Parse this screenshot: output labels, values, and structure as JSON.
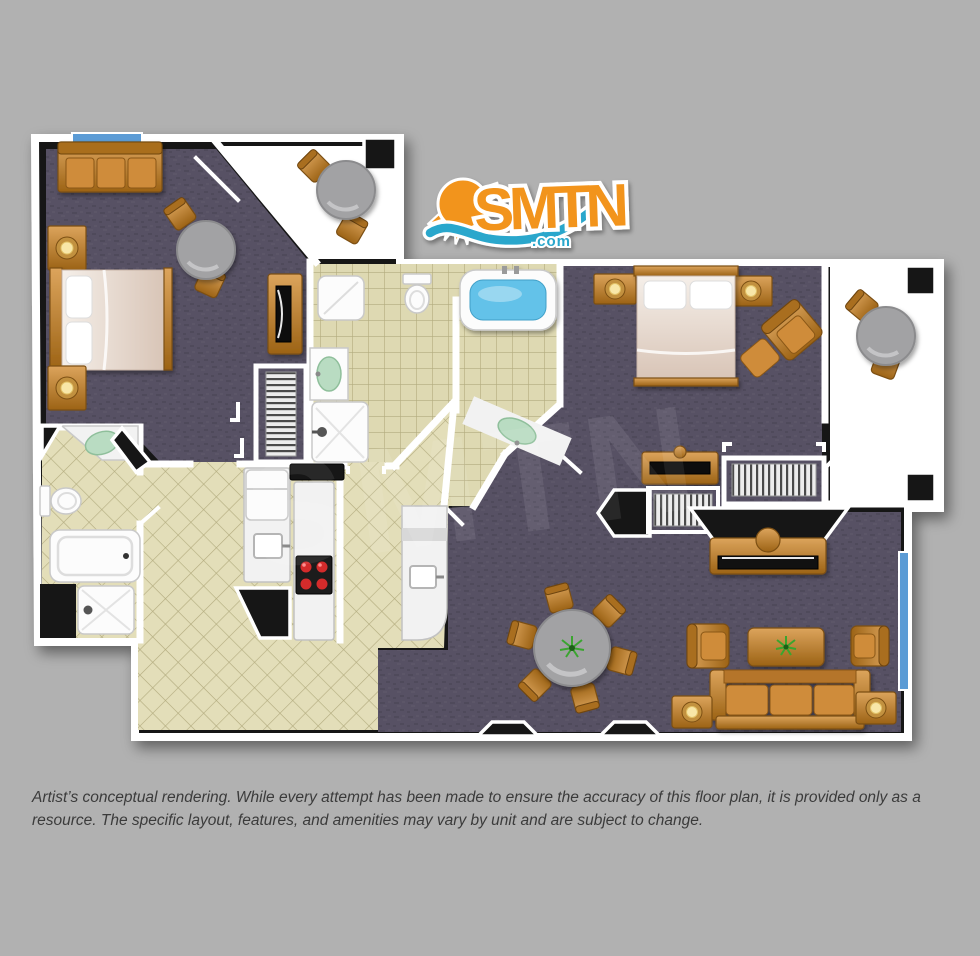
{
  "logo": {
    "brand": "SMTN",
    "tld": ".com",
    "sun_color": "#f2941e",
    "text_color": "#f2941e",
    "wave_color": "#2ba7cc"
  },
  "watermark": "SMTN",
  "disclaimer": "Artist’s conceptual rendering. While every attempt has been made to ensure the accuracy of this floor plan, it is provided only as a resource. The specific layout, features, and amenities may vary by unit and are subject to change.",
  "colors": {
    "background": "#b1b1b1",
    "wall_white": "#ffffff",
    "wall_dark": "#161616",
    "carpet": "#575164",
    "tile": "#ded9b2",
    "tile_line": "#b2ab7e",
    "balcony_floor": "#ffffff",
    "wood_light": "#dca45c",
    "wood_dark": "#9c6315",
    "linen": "#e9dcd2",
    "pillow": "#ffffff",
    "tub_water": "#63c2e9",
    "sink_green": "#b9dcc2",
    "burner_red": "#d42b2b",
    "lamp_glow": "#f8e7a8",
    "window_glass": "#5b9bd5",
    "table_gray": "#a2a2a4",
    "sofa_orange": "#cf8c3a",
    "plant_green": "#3aa52f",
    "disclaimer_text": "#3b3b3b"
  }
}
